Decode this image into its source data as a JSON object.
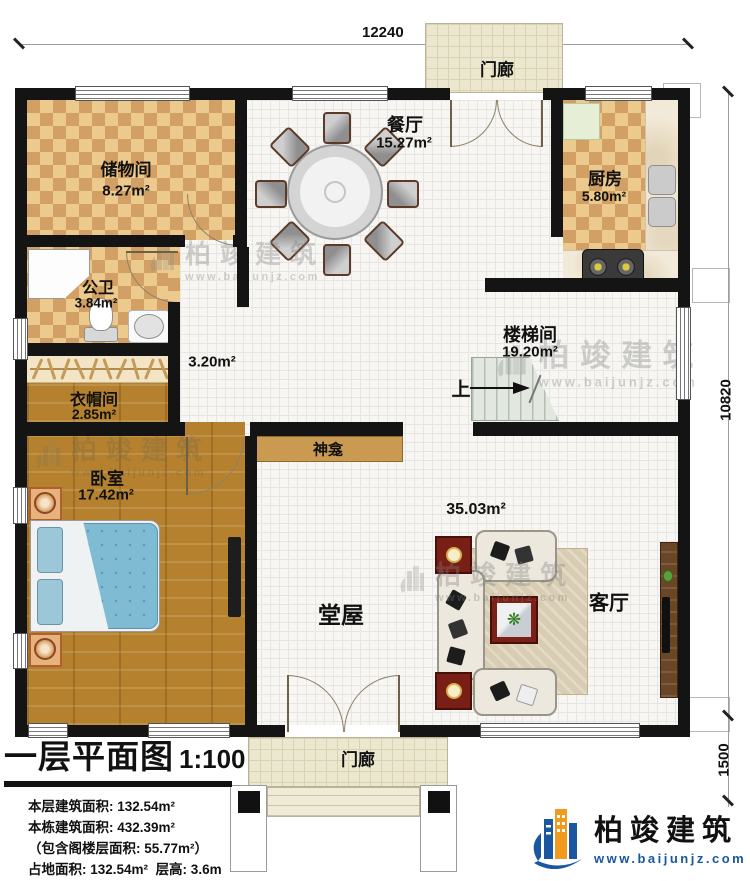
{
  "plan": {
    "dimensions": {
      "top": "12240",
      "right": "10820",
      "bottom_right": "1500"
    },
    "rooms": {
      "dining": {
        "name": "餐厅",
        "area": "15.27m²"
      },
      "storage": {
        "name": "储物间",
        "area": "8.27m²"
      },
      "kitchen": {
        "name": "厨房",
        "area": "5.80m²"
      },
      "bath": {
        "name": "公卫",
        "area": "3.84m²"
      },
      "stairwell": {
        "name": "楼梯间",
        "area": "19.20m²"
      },
      "hallway": {
        "area": "3.20m²"
      },
      "cloak": {
        "name": "衣帽间",
        "area": "2.85m²"
      },
      "bedroom": {
        "name": "卧室",
        "area": "17.42m²"
      },
      "hall": {
        "name": "堂屋",
        "area": "35.03m²"
      },
      "living": {
        "name": "客厅"
      },
      "shrine": {
        "name": "神龛"
      },
      "porch_top": {
        "name": "门廊"
      },
      "porch_bottom": {
        "name": "门廊"
      }
    },
    "stairs_up": "上"
  },
  "title_block": {
    "title": "一层平面图",
    "scale": "1:100",
    "lines": [
      "本层建筑面积: 132.54m²",
      "本栋建筑面积: 432.39m²",
      "（包含阁楼层面积: 55.77m²）"
    ],
    "last_left": "占地面积: 132.54m²",
    "last_right": "层高: 3.6m"
  },
  "logo": {
    "brand": "柏竣建筑",
    "url": "www.baijunjz.com"
  },
  "watermark": {
    "brand": "柏竣建筑",
    "url": "www.baijunjz.com"
  },
  "colors": {
    "wall": "#141414",
    "brand_blue": "#1a57a0",
    "brand_orange": "#f29a1d",
    "checker_light": "#ecc98c",
    "checker_dark": "#d2a064",
    "wood": "#b5812e"
  }
}
